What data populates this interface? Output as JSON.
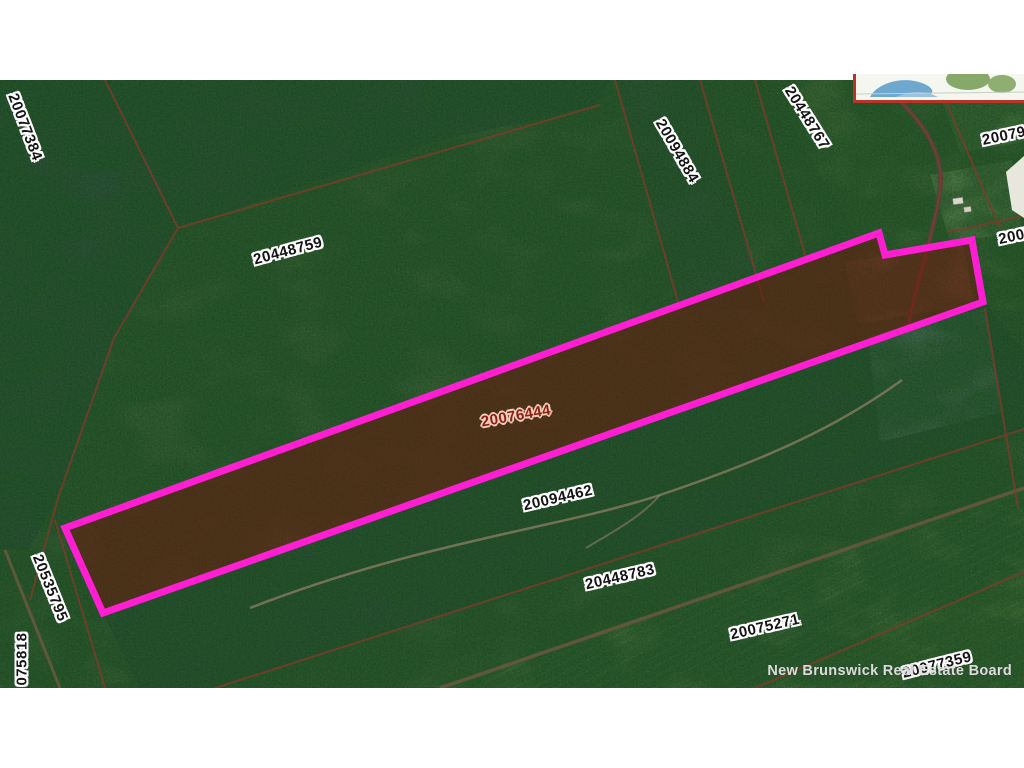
{
  "map": {
    "kind": "aerial-parcel-map",
    "board": "New Brunswick Real Estate Board",
    "highlighted_parcel": {
      "pid": "20076444",
      "outline_color": "#ff1ed2",
      "fill_tint": "#6e150c",
      "label_color": "#8c2015"
    },
    "labels": [
      {
        "text": "20077384"
      },
      {
        "text": "20448759"
      },
      {
        "text": "20094884"
      },
      {
        "text": "20448767"
      },
      {
        "text": "20079"
      },
      {
        "text": "2007"
      },
      {
        "text": "20076444"
      },
      {
        "text": "20094462"
      },
      {
        "text": "20448783"
      },
      {
        "text": "20075271"
      },
      {
        "text": "20535795"
      },
      {
        "text": "075818"
      },
      {
        "text": "20077359"
      }
    ],
    "watermark": {
      "text": "New Brunswick Real Estate Board"
    },
    "colors": {
      "forest_green": "#4f6a49",
      "slate_forest": "#3e5450",
      "field_green": "#66854f",
      "boundary_line": "#7e3b2a",
      "road_brown": "#6b573f",
      "label_halo": "#ffffff",
      "inset_border": "#b53527",
      "inset_water": "#6fa8cf",
      "inset_land": "#86a96a"
    },
    "inset_map": {
      "description": "locator inset map, red border, coastline with water and land"
    }
  }
}
